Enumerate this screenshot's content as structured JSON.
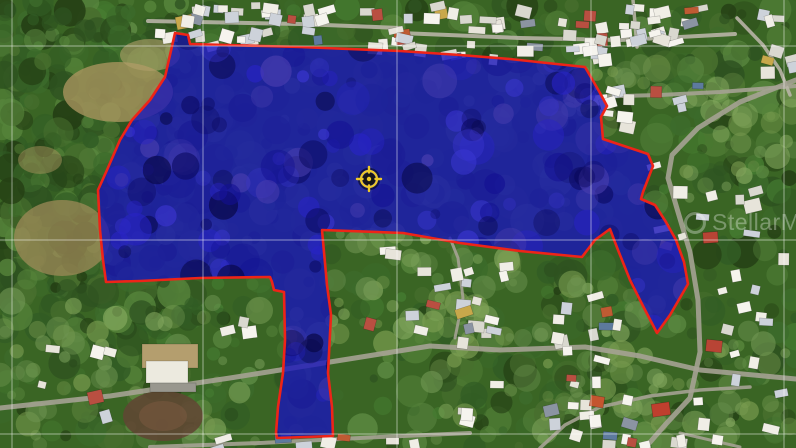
{
  "canvas": {
    "width": 796,
    "height": 448
  },
  "map": {
    "kind": "satellite-aerial-view",
    "base_color": "#3a6524",
    "vegetation_palette": [
      "#2e5220",
      "#3c6b2b",
      "#486f2e",
      "#55833a",
      "#243f14",
      "#315c24",
      "#447a30",
      "#5d8a43"
    ],
    "light_grass_palette": [
      "#6f9552",
      "#85a95f",
      "#7a9c50"
    ],
    "grid": {
      "vertical_x": [
        12,
        203,
        397,
        591,
        784
      ],
      "horizontal_y": [
        46,
        240,
        434
      ],
      "color": "#ffffff",
      "opacity": 0.5,
      "width": 1
    },
    "parcel": {
      "fill": "#1813bb",
      "fill_opacity": 0.78,
      "stroke": "#ee2418",
      "stroke_width": 2.6,
      "texture_palette": [
        "#0b0a62",
        "#121093",
        "#2823c6",
        "#060540",
        "#3b36d2",
        "#4b3fb0"
      ],
      "points": [
        [
          175,
          33
        ],
        [
          188,
          35
        ],
        [
          190,
          44
        ],
        [
          300,
          47
        ],
        [
          400,
          51
        ],
        [
          460,
          55
        ],
        [
          510,
          59
        ],
        [
          547,
          63
        ],
        [
          585,
          67
        ],
        [
          592,
          79
        ],
        [
          600,
          93
        ],
        [
          607,
          106
        ],
        [
          601,
          117
        ],
        [
          603,
          139
        ],
        [
          648,
          154
        ],
        [
          653,
          166
        ],
        [
          643,
          192
        ],
        [
          641,
          199
        ],
        [
          655,
          205
        ],
        [
          666,
          222
        ],
        [
          676,
          240
        ],
        [
          684,
          262
        ],
        [
          688,
          284
        ],
        [
          670,
          315
        ],
        [
          657,
          333
        ],
        [
          643,
          306
        ],
        [
          630,
          280
        ],
        [
          618,
          250
        ],
        [
          613,
          237
        ],
        [
          610,
          229
        ],
        [
          595,
          240
        ],
        [
          582,
          257
        ],
        [
          520,
          251
        ],
        [
          460,
          243
        ],
        [
          403,
          233
        ],
        [
          322,
          230
        ],
        [
          327,
          285
        ],
        [
          331,
          315
        ],
        [
          328,
          373
        ],
        [
          332,
          407
        ],
        [
          333,
          436
        ],
        [
          277,
          438
        ],
        [
          276,
          433
        ],
        [
          278,
          407
        ],
        [
          283,
          373
        ],
        [
          285,
          340
        ],
        [
          284,
          292
        ],
        [
          274,
          290
        ],
        [
          272,
          282
        ],
        [
          270,
          277
        ],
        [
          200,
          278
        ],
        [
          140,
          281
        ],
        [
          106,
          282
        ],
        [
          103,
          260
        ],
        [
          100,
          230
        ],
        [
          98,
          190
        ],
        [
          107,
          170
        ],
        [
          120,
          140
        ],
        [
          132,
          120
        ],
        [
          150,
          100
        ],
        [
          165,
          77
        ],
        [
          170,
          55
        ]
      ]
    },
    "marker": {
      "type": "crosshair-target",
      "x": 369,
      "y": 179,
      "ring_color": "#edc829",
      "core_color": "#16140a"
    },
    "roads": {
      "color": "#a5a294",
      "color_light": "#b8b4a6",
      "lines": [
        {
          "w": 4,
          "pts": [
            [
              148,
              21
            ],
            [
              300,
              24
            ],
            [
              400,
              28
            ]
          ]
        },
        {
          "w": 4,
          "pts": [
            [
              400,
              33
            ],
            [
              520,
              38
            ],
            [
              620,
              40
            ],
            [
              680,
              37
            ],
            [
              735,
              34
            ]
          ]
        },
        {
          "w": 4,
          "pts": [
            [
              585,
              97
            ],
            [
              660,
              95
            ],
            [
              720,
              92
            ],
            [
              796,
              86
            ]
          ]
        },
        {
          "w": 3.5,
          "pts": [
            [
              633,
              0
            ],
            [
              637,
              47
            ]
          ]
        },
        {
          "w": 3.5,
          "pts": [
            [
              737,
              18
            ],
            [
              763,
              45
            ],
            [
              780,
              70
            ],
            [
              790,
              95
            ]
          ]
        },
        {
          "w": 5,
          "pts": [
            [
              796,
              80
            ],
            [
              740,
              102
            ],
            [
              698,
              128
            ],
            [
              672,
              155
            ],
            [
              668,
              178
            ],
            [
              678,
              212
            ],
            [
              690,
              252
            ],
            [
              698,
              300
            ],
            [
              700,
              352
            ],
            [
              690,
              398
            ],
            [
              665,
              425
            ],
            [
              645,
              448
            ]
          ]
        },
        {
          "w": 5,
          "pts": [
            [
              0,
              408
            ],
            [
              110,
              396
            ],
            [
              230,
              378
            ],
            [
              330,
              362
            ],
            [
              430,
              346
            ],
            [
              500,
              350
            ],
            [
              585,
              347
            ],
            [
              640,
              356
            ],
            [
              700,
              370
            ],
            [
              796,
              379
            ]
          ]
        },
        {
          "w": 3.5,
          "pts": [
            [
              540,
              448
            ],
            [
              565,
              425
            ],
            [
              600,
              407
            ],
            [
              650,
              396
            ],
            [
              700,
              390
            ],
            [
              750,
              387
            ]
          ]
        },
        {
          "w": 4,
          "pts": [
            [
              150,
              447
            ],
            [
              260,
              443
            ],
            [
              380,
              437
            ],
            [
              470,
              433
            ]
          ]
        },
        {
          "w": 3,
          "pts": [
            [
              455,
              338
            ],
            [
              463,
              298
            ],
            [
              458,
              258
            ],
            [
              450,
              238
            ]
          ]
        },
        {
          "w": 3,
          "pts": [
            [
              680,
              433
            ],
            [
              740,
              447
            ]
          ]
        }
      ]
    },
    "terrain_patches": {
      "tan": [
        {
          "x": 118,
          "y": 92,
          "rx": 55,
          "ry": 30,
          "c": "#a8945e",
          "o": 0.8
        },
        {
          "x": 62,
          "y": 238,
          "rx": 48,
          "ry": 38,
          "c": "#9d8a58",
          "o": 0.75
        },
        {
          "x": 150,
          "y": 55,
          "rx": 30,
          "ry": 16,
          "c": "#b3a06b",
          "o": 0.6
        },
        {
          "x": 40,
          "y": 160,
          "rx": 22,
          "ry": 14,
          "c": "#a8945e",
          "o": 0.5
        }
      ],
      "light_grass_regions": [
        {
          "x": 330,
          "y": 232,
          "w": 190,
          "h": 115,
          "n": 45
        },
        {
          "x": 430,
          "y": 280,
          "w": 230,
          "h": 165,
          "n": 55
        },
        {
          "x": 540,
          "y": 60,
          "w": 120,
          "h": 70,
          "n": 25
        },
        {
          "x": 0,
          "y": 300,
          "w": 270,
          "h": 148,
          "n": 50
        },
        {
          "x": 680,
          "y": 80,
          "w": 116,
          "h": 120,
          "n": 30
        },
        {
          "x": 620,
          "y": 330,
          "w": 176,
          "h": 118,
          "n": 35
        }
      ]
    },
    "buildings": {
      "roof_palette": [
        "#f0eee6",
        "#e7e4da",
        "#f6f4ee",
        "#d9d8cf",
        "#cdd2da"
      ],
      "accent_palette": [
        "#b94f41",
        "#bf5b33",
        "#5d7a9e",
        "#8b94a2",
        "#c8a84b"
      ],
      "clusters": [
        {
          "x": 150,
          "y": 2,
          "w": 255,
          "h": 15,
          "n": 24
        },
        {
          "x": 152,
          "y": 27,
          "w": 250,
          "h": 16,
          "n": 20
        },
        {
          "x": 402,
          "y": 2,
          "w": 290,
          "h": 28,
          "n": 32
        },
        {
          "x": 560,
          "y": 30,
          "w": 120,
          "h": 14,
          "n": 10
        },
        {
          "x": 402,
          "y": 40,
          "w": 200,
          "h": 16,
          "n": 16
        },
        {
          "x": 588,
          "y": 70,
          "w": 110,
          "h": 60,
          "n": 12
        },
        {
          "x": 748,
          "y": 2,
          "w": 48,
          "h": 70,
          "n": 8
        },
        {
          "x": 645,
          "y": 140,
          "w": 150,
          "h": 115,
          "n": 12
        },
        {
          "x": 690,
          "y": 262,
          "w": 106,
          "h": 115,
          "n": 9
        },
        {
          "x": 560,
          "y": 288,
          "w": 60,
          "h": 42,
          "n": 6
        },
        {
          "x": 540,
          "y": 368,
          "w": 256,
          "h": 75,
          "n": 16
        },
        {
          "x": 336,
          "y": 234,
          "w": 178,
          "h": 108,
          "n": 17
        },
        {
          "x": 440,
          "y": 285,
          "w": 215,
          "h": 155,
          "n": 24
        },
        {
          "x": 0,
          "y": 332,
          "w": 118,
          "h": 108,
          "n": 6
        },
        {
          "x": 208,
          "y": 430,
          "w": 210,
          "h": 16,
          "n": 8
        },
        {
          "x": 215,
          "y": 315,
          "w": 60,
          "h": 25,
          "n": 3
        }
      ],
      "accent_roofs": [
        {
          "x": 652,
          "y": 403,
          "w": 18,
          "h": 13,
          "c": "#bf3f2e",
          "r": -8
        },
        {
          "x": 706,
          "y": 340,
          "w": 16,
          "h": 12,
          "c": "#b84435",
          "r": 6
        },
        {
          "x": 703,
          "y": 232,
          "w": 15,
          "h": 11,
          "c": "#b84435",
          "r": -4
        },
        {
          "x": 590,
          "y": 396,
          "w": 14,
          "h": 11,
          "c": "#c4552f",
          "r": 10
        }
      ],
      "industrial_site": {
        "pad": {
          "x": 142,
          "y": 344,
          "w": 56,
          "h": 24,
          "c": "#b49e6e"
        },
        "building": {
          "x": 146,
          "y": 361,
          "w": 42,
          "h": 22,
          "c": "#eceadf"
        },
        "apron": {
          "x": 150,
          "y": 383,
          "w": 46,
          "h": 9,
          "c": "#98978e"
        },
        "field": {
          "x": 163,
          "y": 416,
          "rx": 40,
          "ry": 25,
          "c": "#5f4733"
        }
      }
    }
  },
  "watermark": {
    "text": "StellarMLS",
    "color": "#ffffff",
    "opacity": 0.32,
    "x": 684,
    "y": 211
  }
}
